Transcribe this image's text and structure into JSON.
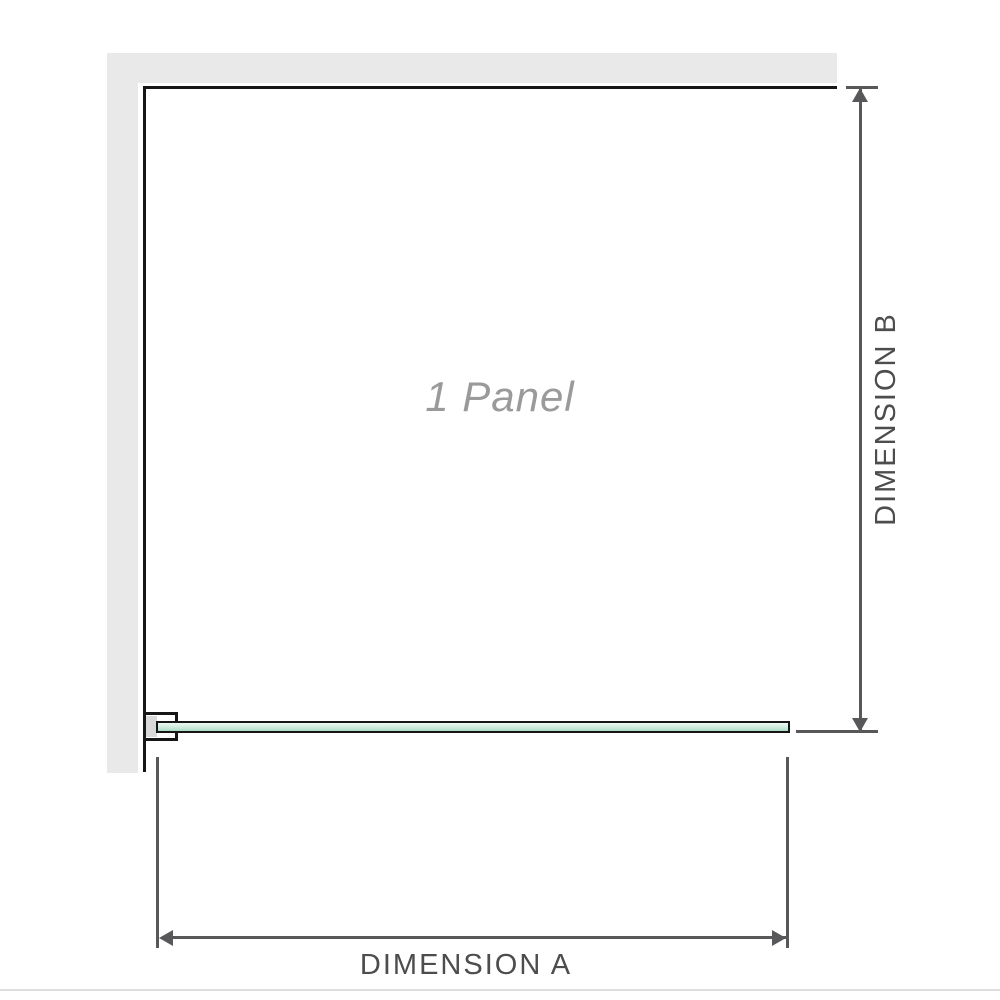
{
  "diagram": {
    "panel_label": "1 Panel",
    "dimension_a_label": "DIMENSION A",
    "dimension_b_label": "DIMENSION B"
  },
  "colors": {
    "wall": "#e9e9e9",
    "outline": "#161616",
    "dimension": "#58585a",
    "label-text": "#4d4d4d",
    "panel-text": "#9a9a9a",
    "glass-top": "#edf8f2",
    "glass-mid": "#cdeadd",
    "glass-bottom": "#a9dcc4",
    "bracket-pad": "#d9d9d9",
    "divider": "#dedede",
    "bg": "#ffffff"
  }
}
